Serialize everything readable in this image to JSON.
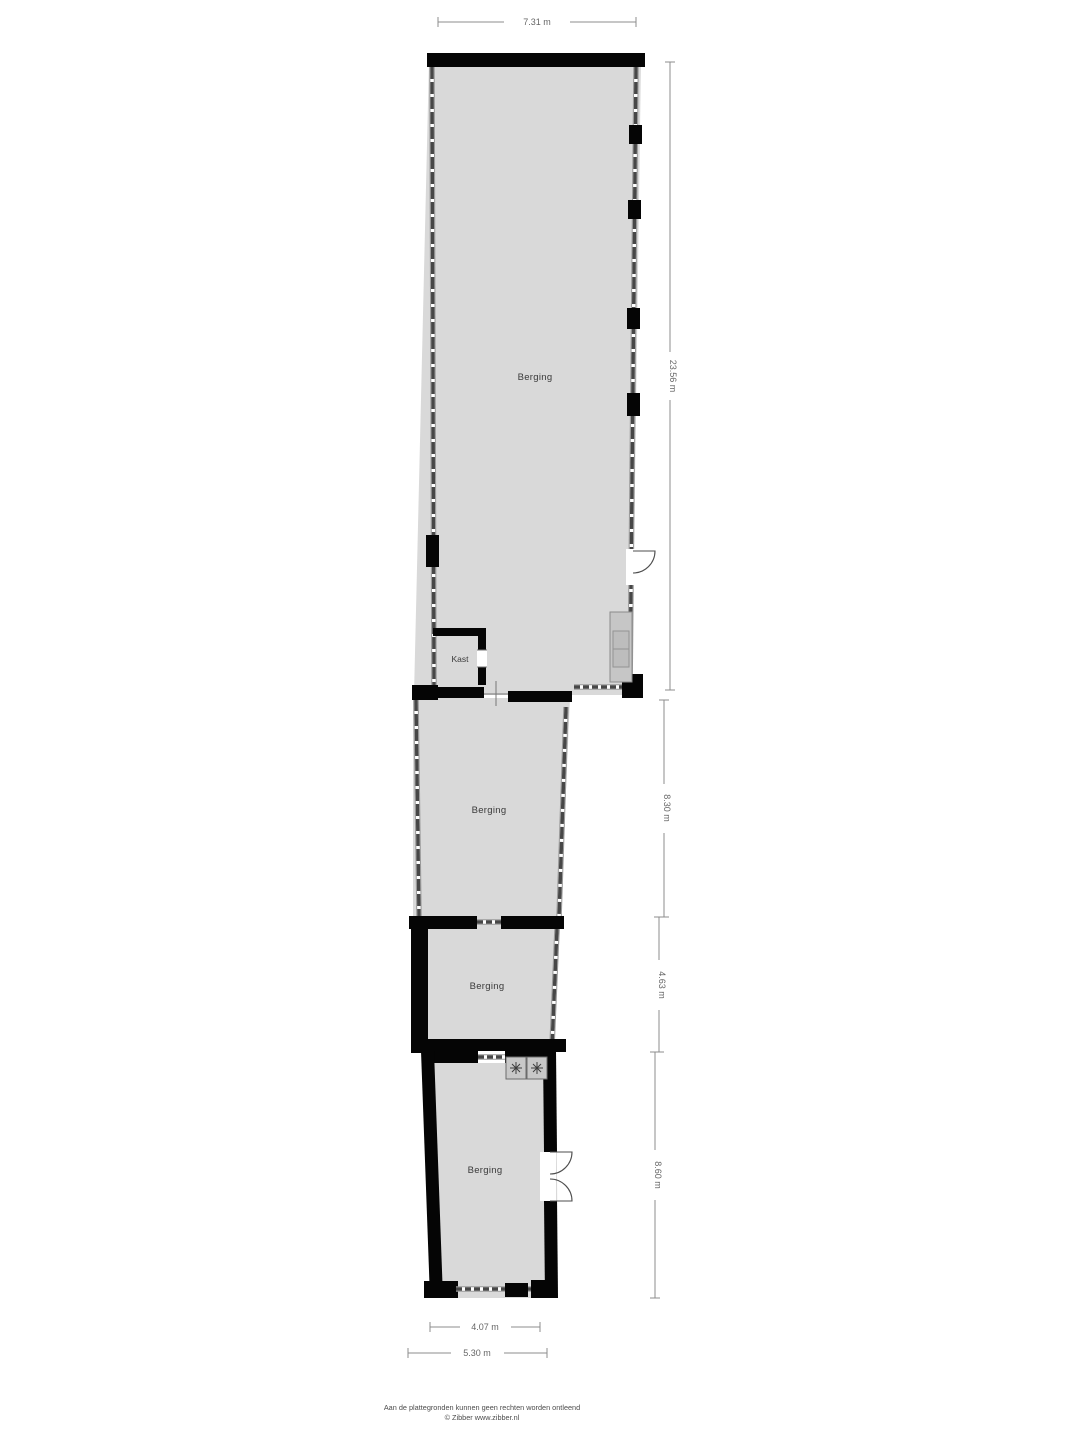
{
  "title": "Floor plan - Berging (storage) layout",
  "colors": {
    "background": "#ffffff",
    "room_fill": "#d9d9d9",
    "wall": "#050505",
    "label_text": "#3a3a3a",
    "dimension_text": "#666666"
  },
  "rooms": {
    "main": {
      "label": "Berging"
    },
    "kast": {
      "label": "Kast"
    },
    "middle": {
      "label": "Berging"
    },
    "small": {
      "label": "Berging"
    },
    "bottom": {
      "label": "Berging"
    }
  },
  "dimensions": {
    "top_width": "7.31 m",
    "total_height": "23.56 m",
    "middle_height": "8.30 m",
    "small_height": "4.63 m",
    "bottom_height": "8.60 m",
    "bottom_inner_width": "4.07 m",
    "bottom_outer_width": "5.30 m"
  },
  "icons": {
    "washer": "✳"
  },
  "footer": {
    "disclaimer": "Aan de plattegronden kunnen geen rechten worden ontleend",
    "copyright": "© Zibber www.zibber.nl"
  }
}
